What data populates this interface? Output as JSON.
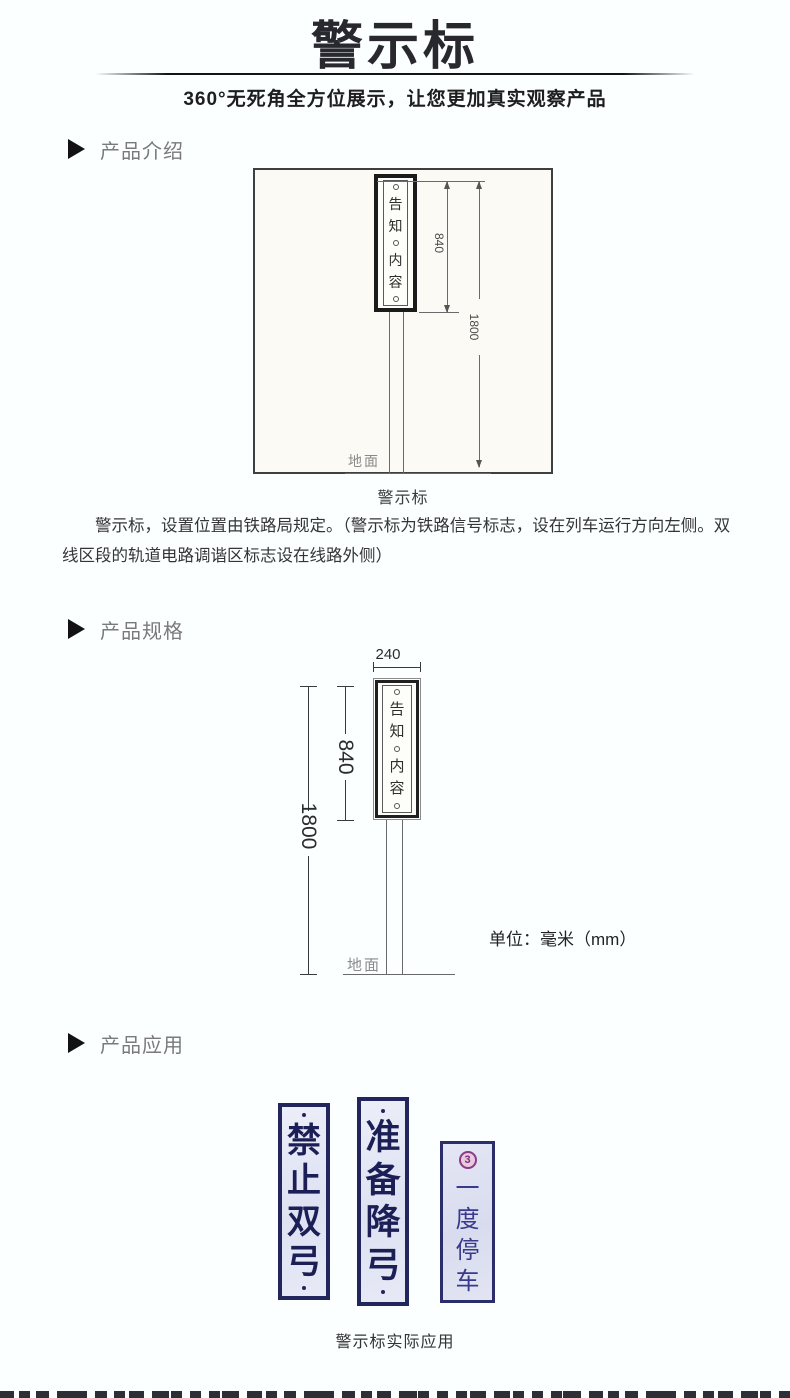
{
  "header": {
    "title": "警示标",
    "subtitle": "360°无死角全方位展示，让您更加真实观察产品"
  },
  "sections": {
    "intro": {
      "label": "产品介绍"
    },
    "spec": {
      "label": "产品规格"
    },
    "app": {
      "label": "产品应用"
    }
  },
  "intro": {
    "caption": "警示标",
    "paragraph": "警示标，设置位置由铁路局规定。（警示标为铁路信号标志，设在列车运行方向左侧。双线区段的轨道电路调谐区标志设在线路外侧）"
  },
  "diagram1": {
    "plate_chars": [
      "告",
      "知",
      "内",
      "容"
    ],
    "dim_840": "840",
    "dim_1800": "1800",
    "ground_label": "地面"
  },
  "diagram2": {
    "plate_chars": [
      "告",
      "知",
      "内",
      "容"
    ],
    "dim_240": "240",
    "dim_840": "840",
    "dim_1800": "1800",
    "ground_label": "地面",
    "unit_note": "单位：毫米（mm）"
  },
  "application": {
    "signs": [
      {
        "chars": [
          "禁",
          "止",
          "双",
          "弓"
        ]
      },
      {
        "chars": [
          "准",
          "备",
          "降",
          "弓"
        ]
      },
      {
        "chars": [
          "一",
          "度",
          "停",
          "车"
        ],
        "badge": "3"
      }
    ],
    "caption": "警示标实际应用"
  },
  "colors": {
    "title_black": "#28282e",
    "section_label_gray": "#7a7a7a",
    "drawing_line_gray": "#6a6a6a",
    "sign_navy": "#23265c",
    "sign_background": "#e2e5f3",
    "badge_pink": "#8a3a88",
    "page_background": "#fcffff"
  }
}
